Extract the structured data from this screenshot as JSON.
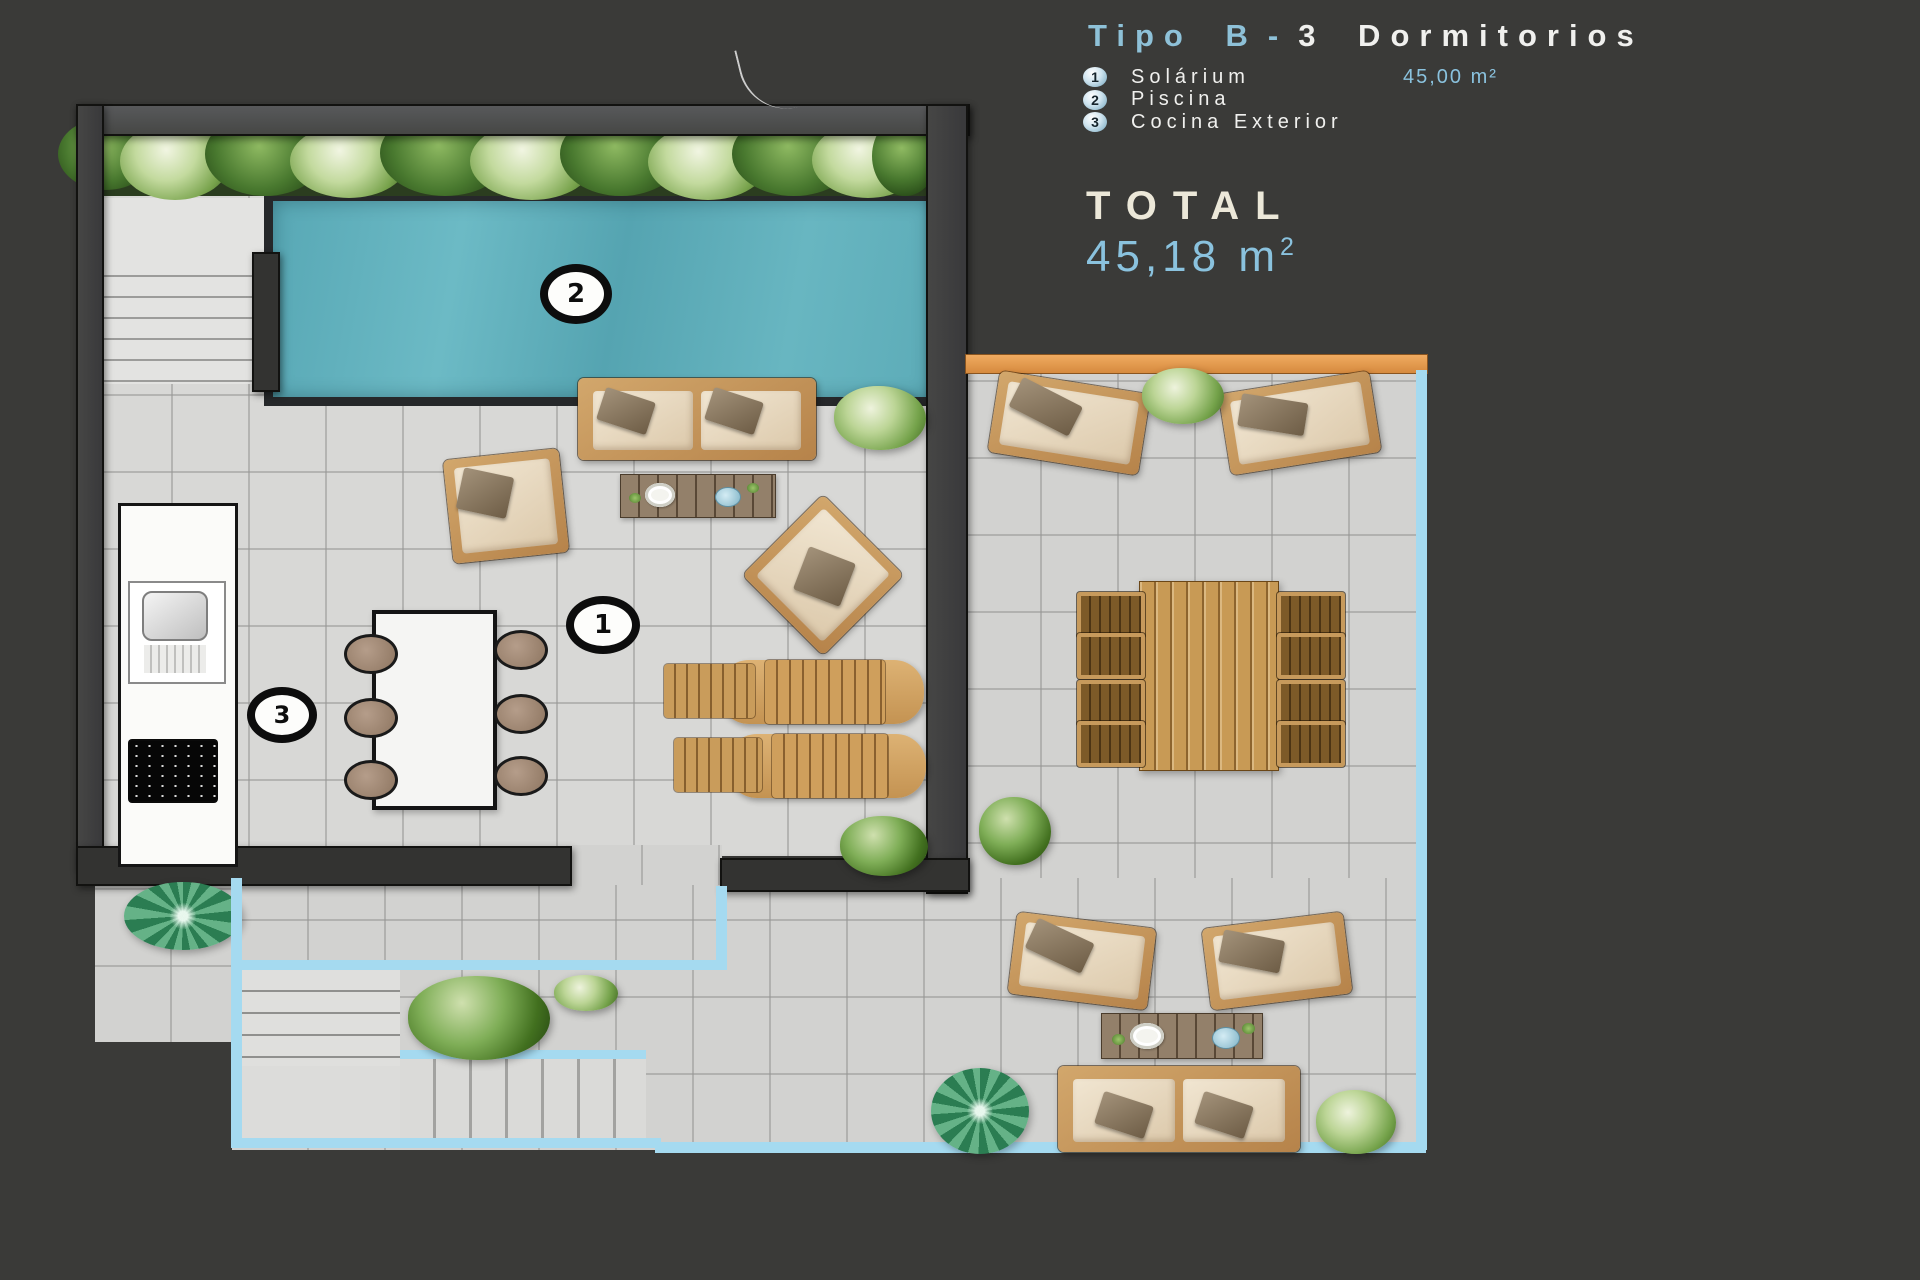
{
  "header": {
    "title": {
      "accent": "Tipo B",
      "dash": "-",
      "rest": "3 Dormitorios"
    },
    "legend": [
      {
        "num": "1",
        "label": "Solárium",
        "area": "45,00 m²"
      },
      {
        "num": "2",
        "label": "Piscina",
        "area": ""
      },
      {
        "num": "3",
        "label": "Cocina Exterior",
        "area": ""
      }
    ],
    "total": {
      "label": "TOTAL",
      "value": "45,18 m",
      "sup": "2"
    }
  },
  "plan": {
    "markers": {
      "solarium": "1",
      "piscina": "2",
      "cocina": "3"
    }
  },
  "colors": {
    "background": "#3a3a38",
    "accent_blue": "#8ec1d8",
    "value_blue": "#8ac2de",
    "cream": "#ece8d9",
    "text_white": "#f0f0ee",
    "pool": "#64b3bf",
    "edge_blue": "#a5daf0",
    "orange_band": "#e49a52",
    "wood": "#c89a55"
  }
}
